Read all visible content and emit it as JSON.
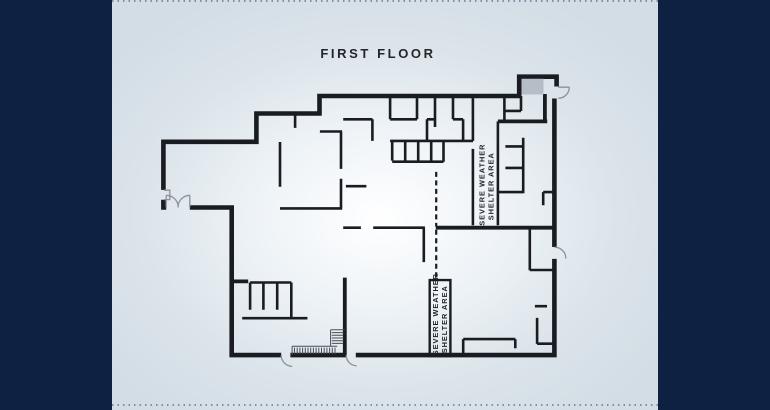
{
  "title": "FIRST FLOOR",
  "labels": {
    "shelter_area_1": {
      "line1": "SEVERE WEATHER",
      "line2": "SHELTER AREA"
    },
    "shelter_area_2": {
      "line1": "SEVERE WEATHER",
      "line2": "SHELTER AREA"
    }
  },
  "colors": {
    "sidebar_navy": "#0e2142",
    "panel_light": "#d6e0e8",
    "panel_glow": "#ffffff",
    "wall": "#191c20",
    "door_arc_gray": "#8a9199",
    "stair_tread": "#474d55",
    "entry_mat_gray": "#b5bec6",
    "title_text": "#23262b"
  },
  "floorplan": {
    "paths": [
      {
        "n": "outer-wall",
        "k": "o",
        "d": "M161.3,141.8 H258.6 M256.4,143.9 V111.6 M254.3,113.5 H321.6 M319.5,115.6 V93.7 M317.4,96 H521.3 M519.2,96 V74.6 M517.1,76.7 H558.7 M556.6,74.6 V86.5 M554.4,98.5 V247 M554.4,258.9 V357.4 M556.7,355.1 H355.8 M346.2,355.1 H290.4 M281.2,355.1 H229.4 M231.7,357.4 V205.2 M233.9,207.5 H189.8 M166.2,207.5 H161.2 M163.4,209.7 V199.8 M163.4,189.9 V139.7"
      },
      {
        "n": "thick-interior-wall",
        "k": "t",
        "d": "M497.9,121.4 H547.2 M544.9,94 V121.4 M435.8,227.7 H555.5 M231.7,281.4 H248.2 M344.8,277.6 V355.1"
      },
      {
        "n": "interior-walls",
        "k": "w",
        "d": "M280,142 V186.8 M280,208.4 H342.2 M341,131.9 V168.9 M341,178.8 V208.4 M319.9,131.5 H342.1 M295.1,113.5 V127.9 M343.2,119.3 H372.4 M390.1,119.3 H417 M427,119.3 H435 M453,119.3 H463.1 M390.1,96 V119.3 M417,96 V119.3 M435,96 V127 M453,96 V119.3 M472.9,96 V140.9 M372.4,119.3 V140.9 M427,119.3 V140.9 M463.1,119.3 V140.9 M390.1,140.9 H473 M472.9,148.9 V225.3 M497.9,121.4 V225.3 M392.2,140.9 V160.6 M405.2,140.9 V160.6 M418.2,140.9 V160.6 M431.2,140.9 V160.6 M443.5,140.9 V161.7 M392.2,161.7 H443.5 M504.4,96 V120 M521,96 V111 M504.4,110.9 H521 M523.2,137.8 V193.2 M505.4,146.4 H523.2 M505.4,167.9 H523.2 M498,192.1 H523.2 M343.2,227.7 H360.9 M373.2,227.7 H424.9 M423.8,227.7 V262.1 M529.8,227.7 V270.2 M529.8,270 H554.4 M543.2,192.1 H554.4 M543.2,192.1 V205.2 M345.9,186.2 H366.4 M250.1,282.5 H291.3 M250.1,282.5 V309.8 M263.4,282.5 V309.8 M277.2,282.5 V309.8 M291.3,282.5 V318.2 M242.2,318.2 H307.4 M534.9,306.2 H547 M537.1,317.9 V343.9 M537.1,343.7 H554.4 M463.2,357 V339.1 M463.2,339.1 H515.3 M515.3,339.1 V348.2"
      },
      {
        "n": "shelter-area-2-box",
        "k": "b",
        "d": "M429.7,280.1 H450.4 V356 H429.7 Z"
      },
      {
        "n": "dashed-partition",
        "k": "d",
        "d": "M436.2,171.9 V226.5 M436.2,229.8 V279.6"
      },
      {
        "n": "door-arcs-and-window",
        "k": "a",
        "d": "M166.2,195.3 A12,12 0 0 1 178.2,207.4 M166.2,207.4 V195.3 M190,195.3 A12,12 0 0 0 178,207.4 M189.8,207.4 V195.3 M281.2,355.3 A11,11 0 0 0 292.2,366.3 M346.2,355.3 A10.5,10.5 0 0 0 356.7,365.8 M554.6,247.2 A11.3,11.3 0 0 1 565.9,258.5 M569.3,87.2 A11,11 0 0 1 558.3,98.2 M558.3,87.2 H569.3 M163.9,190.2 H169.8 V199.6 H163.9"
      },
      {
        "n": "stair-treads",
        "k": "s",
        "d": "M292.1,346.3 H337.2 M292.1,346.3 V355 M294.5,347.6 V354.2 M297.2,347.6 V354.2 M299.9,347.6 V354.2 M302.6,347.6 V354.2 M305.3,347.6 V354.2 M308,347.6 V354.2 M310.7,347.6 V354.2 M313.4,347.6 V354.2 M316.1,347.6 V354.2 M318.8,347.6 V354.2 M321.5,347.6 V354.2 M324.2,347.6 V354.2 M326.9,347.6 V354.2 M329.6,347.6 V354.2 M332.3,347.6 V354.2 M335,347.6 V354.2 M330.6,329.8 V346.3 M330.6,329.8 H344.8 M331.8,332.6 H343.4 M331.8,335.3 H343.4 M331.8,338 H343.4 M331.8,340.7 H343.4 M331.8,343.4 H343.4"
      },
      {
        "n": "entry-mat",
        "k": "f",
        "d": "M521.5,78.8 H543.5 V94.5 H521.5 Z"
      }
    ]
  }
}
